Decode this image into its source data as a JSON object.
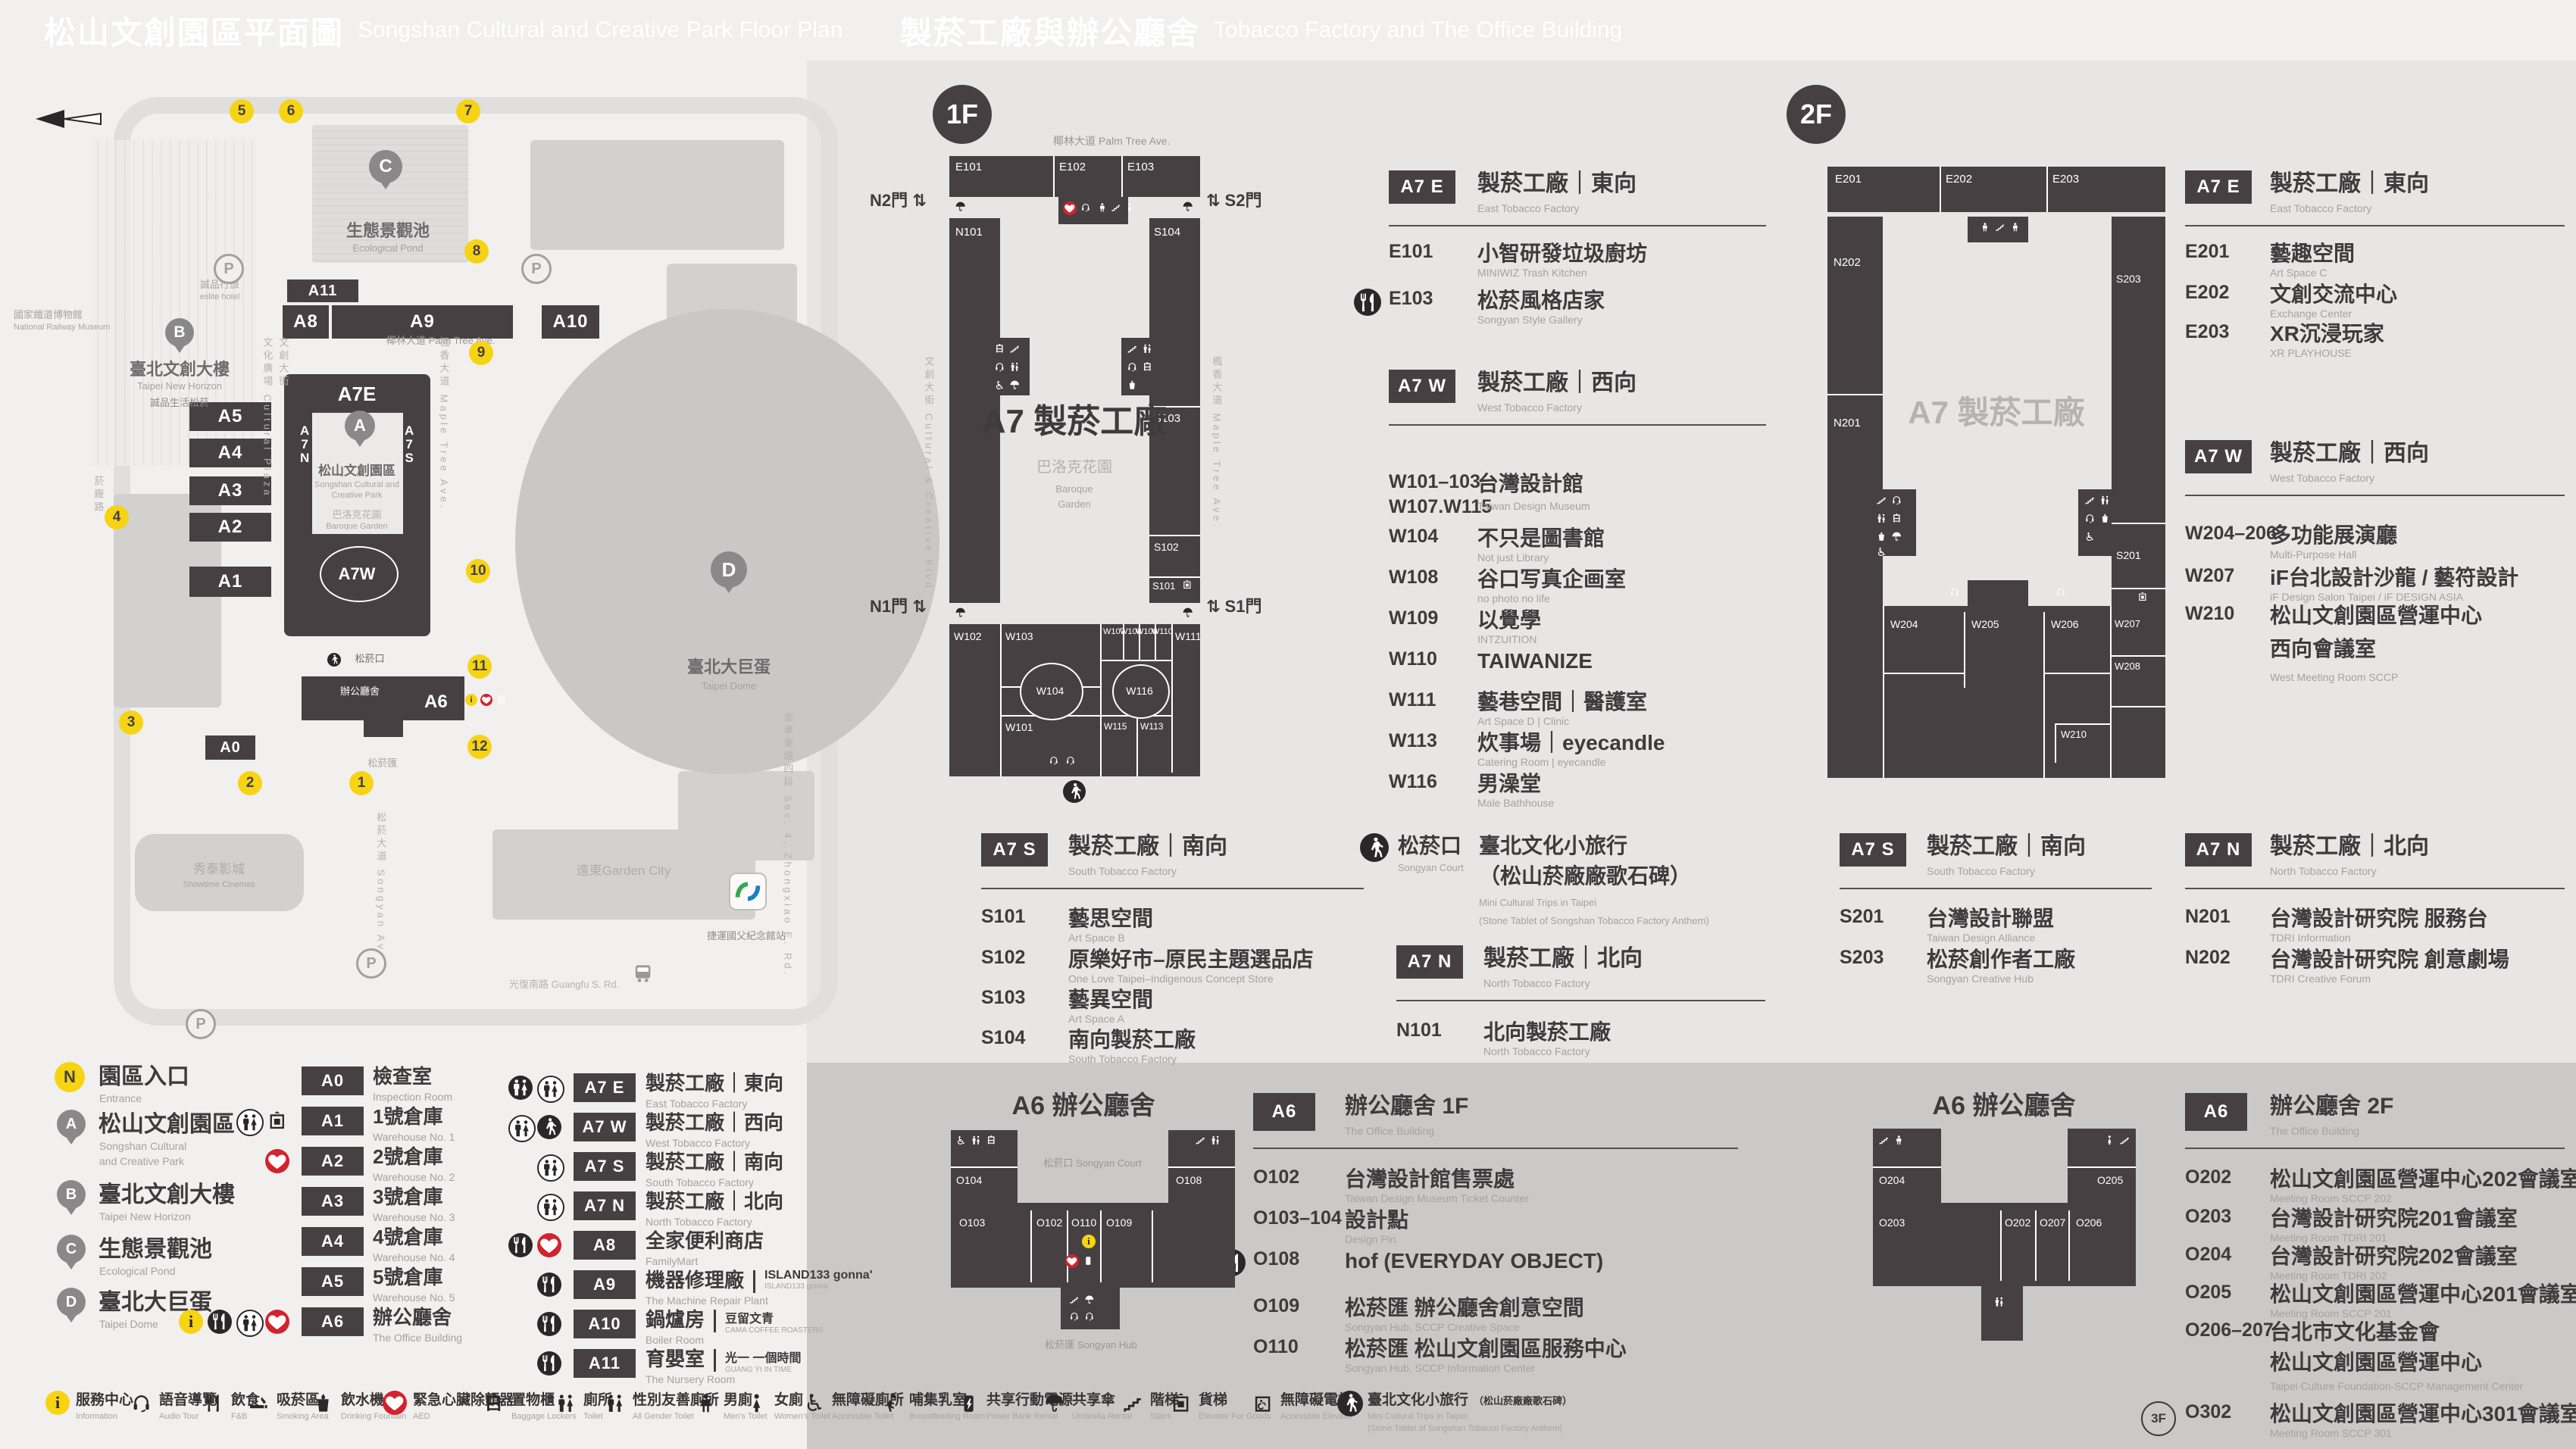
{
  "header_left": {
    "zh": "松山文創園區平面圖",
    "en": "Songshan Cultural and Creative Park Floor Plan"
  },
  "header_right": {
    "zh": "製菸工廠與辦公廳舍",
    "en": "Tobacco Factory and The Office Building"
  },
  "map": {
    "streets": [
      {
        "zh": "椰林大道",
        "en": "Palm Tree Ave."
      },
      {
        "zh": "文創大街",
        "en": "Cultural & Creative Blvd."
      },
      {
        "zh": "文化廣場",
        "en": "Cultural Plaza"
      },
      {
        "zh": "楓香大道",
        "en": "Maple Tree Ave."
      },
      {
        "zh": "菸廠路",
        "en": ""
      },
      {
        "zh": "松菸大道",
        "en": "Songyan Ave."
      },
      {
        "zh": "光復南路",
        "en": "Guangfu S. Rd."
      },
      {
        "zh": "忠孝東路四段",
        "en": "Sec. 4, Zhongxiao E. Rd."
      }
    ],
    "places": [
      {
        "zh": "國家鐵道博物館",
        "en": "National Railway Museum"
      },
      {
        "zh": "誠品行旅",
        "en": "eslite hotel"
      },
      {
        "zh": "誠品生活松菸",
        "en": ""
      },
      {
        "zh": "秀泰影城",
        "en": "Showtime Cinemas"
      },
      {
        "zh": "遠東Garden City",
        "en": ""
      },
      {
        "zh": "捷運國父紀念館站",
        "en": ""
      },
      {
        "zh": "松菸口",
        "en": "Songyan Court"
      },
      {
        "zh": "辦公廳舍",
        "en": "The Office Building"
      },
      {
        "zh": "松菸匯",
        "en": "Songyan Hub"
      },
      {
        "zh": "巴洛克花園",
        "en": "Baroque Garden"
      },
      {
        "zh": "生態景觀池",
        "en": "Ecological Pond"
      },
      {
        "zh": "臺北大巨蛋",
        "en": "Taipei Dome"
      },
      {
        "zh": "松山文創園區",
        "en1": "Songshan Cultural and",
        "en2": "Creative Park"
      },
      {
        "zh": "臺北文創大樓",
        "en": "Taipei New Horizon"
      }
    ],
    "bars": [
      "A11",
      "A8",
      "A9",
      "A10",
      "A5",
      "A4",
      "A3",
      "A2",
      "A1",
      "A0",
      "A6",
      "A7E",
      "A7W",
      "A7N",
      "A7S"
    ],
    "entrances": [
      "1",
      "2",
      "3",
      "4",
      "5",
      "6",
      "7",
      "8",
      "9",
      "10",
      "11",
      "12"
    ]
  },
  "legend": {
    "places": [
      {
        "marker": "N",
        "zh": "園區入口",
        "en1": "Entrance",
        "en2": ""
      },
      {
        "marker": "A",
        "zh": "松山文創園區",
        "en1": "Songshan Cultural",
        "en2": "and Creative Park"
      },
      {
        "marker": "B",
        "zh": "臺北文創大樓",
        "en1": "Taipei New Horizon",
        "en2": ""
      },
      {
        "marker": "C",
        "zh": "生態景觀池",
        "en1": "Ecological Pond",
        "en2": ""
      },
      {
        "marker": "D",
        "zh": "臺北大巨蛋",
        "en1": "Taipei Dome",
        "en2": ""
      }
    ],
    "buildings": [
      {
        "code": "A0",
        "zh": "檢查室",
        "en": "Inspection Room",
        "icons": []
      },
      {
        "code": "A1",
        "zh": "1號倉庫",
        "en": "Warehouse No. 1",
        "icons": [
          "goodsel_p",
          "toilet_o"
        ]
      },
      {
        "code": "A2",
        "zh": "2號倉庫",
        "en": "Warehouse No. 2",
        "icons": [
          "aed"
        ]
      },
      {
        "code": "A3",
        "zh": "3號倉庫",
        "en": "Warehouse No. 3",
        "icons": []
      },
      {
        "code": "A4",
        "zh": "4號倉庫",
        "en": "Warehouse No. 4",
        "icons": []
      },
      {
        "code": "A5",
        "zh": "5號倉庫",
        "en": "Warehouse No. 5",
        "icons": []
      },
      {
        "code": "A6",
        "zh": "辦公廳舍",
        "en": "The Office Building",
        "icons": [
          "aed",
          "toilet_o",
          "fnb_s",
          "info"
        ]
      },
      {
        "code": "A7 E",
        "zh": "製菸工廠｜東向",
        "en": "East Tobacco Factory",
        "icons": [
          "toilet_o",
          "toilet_s"
        ]
      },
      {
        "code": "A7 W",
        "zh": "製菸工廠｜西向",
        "en": "West Tobacco Factory",
        "icons": [
          "walk_s",
          "toilet_o"
        ]
      },
      {
        "code": "A7 S",
        "zh": "製菸工廠｜南向",
        "en": "South Tobacco Factory",
        "icons": [
          "toilet_o"
        ]
      },
      {
        "code": "A7 N",
        "zh": "製菸工廠｜北向",
        "en": "North Tobacco Factory",
        "icons": [
          "toilet_o"
        ]
      },
      {
        "code": "A8",
        "zh": "全家便利商店",
        "en": "FamilyMart",
        "icons": [
          "aed",
          "fnb_s"
        ]
      },
      {
        "code": "A9",
        "zh": "機器修理廠",
        "en": "The Machine Repair Plant",
        "brand": "ISLAND133 gonna'",
        "brand_sub": "ISLAND133 gonna'",
        "icons": [
          "fnb_s"
        ]
      },
      {
        "code": "A10",
        "zh": "鍋爐房",
        "en": "Boiler Room",
        "brand": "豆留文青",
        "brand_sub": "CAMA COFFEE ROASTERS",
        "icons": [
          "fnb_s"
        ]
      },
      {
        "code": "A11",
        "zh": "育嬰室",
        "en": "The Nursery Room",
        "brand": "光一 一個時間",
        "brand_sub": "GUANG YI IN TIME",
        "icons": [
          "fnb_s"
        ]
      }
    ]
  },
  "facilities": [
    {
      "icon": "info",
      "zh": "服務中心",
      "en": "Information"
    },
    {
      "icon": "audio",
      "zh": "語音導覽",
      "en": "Audio Tour"
    },
    {
      "icon": "fnb",
      "zh": "飲食",
      "en": "F&B"
    },
    {
      "icon": "smoking",
      "zh": "吸菸區",
      "en": "Smoking Area"
    },
    {
      "icon": "water",
      "zh": "飲水機",
      "en": "Drinking Fountain"
    },
    {
      "icon": "aed",
      "zh": "緊急心臟除顫器",
      "en": "AED"
    },
    {
      "icon": "locker",
      "zh": "置物櫃",
      "en": "Baggage Lockers"
    },
    {
      "icon": "toilet",
      "zh": "廁所",
      "en": "Toilet"
    },
    {
      "icon": "allgender",
      "zh": "性別友善廁所",
      "en": "All Gender Toilet"
    },
    {
      "icon": "mens",
      "zh": "男廁",
      "en": "Men's Toilet"
    },
    {
      "icon": "womens",
      "zh": "女廁",
      "en": "Women's Toilet"
    },
    {
      "icon": "accessible",
      "zh": "無障礙廁所",
      "en": "Accessible Toilet"
    },
    {
      "icon": "nursing",
      "zh": "哺集乳室",
      "en": "Breastfeeding Room"
    },
    {
      "icon": "powerbank",
      "zh": "共享行動電源",
      "en": "Power Bank Rental"
    },
    {
      "icon": "umbrella",
      "zh": "共享傘",
      "en": "Umbrella Rental"
    },
    {
      "icon": "stairs",
      "zh": "階梯",
      "en": "Stairs"
    },
    {
      "icon": "goodsel",
      "zh": "貨梯",
      "en": "Elevator For Goods"
    },
    {
      "icon": "accel",
      "zh": "無障礙電梯",
      "en": "Accessible Elevator"
    },
    {
      "icon": "minitrip",
      "zh": "臺北文化小旅行",
      "zh2": "（松山菸廠廠歌石碑）",
      "en": "Mini Cultural Trips in Taipei",
      "en2": "(Stone Tablet of Songshan Tobacco Factory Anthem)"
    }
  ],
  "floor1": {
    "badge": "1F",
    "plan": {
      "rooms": [
        "E101",
        "E102",
        "E103",
        "N101",
        "S104",
        "S103",
        "S102",
        "S101",
        "W102",
        "W103",
        "W104",
        "W101",
        "W107",
        "W108",
        "W109",
        "W110",
        "W116",
        "W115",
        "W113",
        "W111"
      ],
      "gates": [
        "N2門 ⇅",
        "⇅ S2門",
        "N1門 ⇅",
        "⇅ S1門"
      ],
      "center": "A7 製菸工廠",
      "garden_zh": "巴洛克花園",
      "garden_en1": "Baroque",
      "garden_en2": "Garden",
      "street_top_zh": "椰林大道",
      "street_top_en": "Palm Tree Ave.",
      "street_left": "文創大街 Cultural & Creative Blvd.",
      "street_right": "楓香大道 Maple Tree Ave."
    },
    "sections": [
      {
        "badge": "A7 E",
        "zh": "製菸工廠｜東向",
        "en": "East Tobacco Factory",
        "rooms": [
          {
            "code": "E101",
            "zh": "小智研發垃圾廚坊",
            "en": "MINIWIZ Trash Kitchen"
          },
          {
            "code": "E103",
            "zh": "松菸風格店家",
            "en": "Songyan Style Gallery",
            "icon": "fnb_s"
          }
        ]
      },
      {
        "badge": "A7 W",
        "zh": "製菸工廠｜西向",
        "en": "West Tobacco Factory",
        "rooms": [
          {
            "code": "W101–103",
            "code2": "W107.W115",
            "zh": "台灣設計館",
            "en": "Taiwan Design Museum"
          },
          {
            "code": "W104",
            "zh": "不只是圖書館",
            "en": "Not just Library"
          },
          {
            "code": "W108",
            "zh": "谷口写真企画室",
            "en": "no photo no life"
          },
          {
            "code": "W109",
            "zh": "以覺學",
            "en": "INTZUITION"
          },
          {
            "code": "W110",
            "zh": "TAIWANIZE",
            "en": ""
          },
          {
            "code": "W111",
            "zh": "藝巷空間｜醫護室",
            "en": "Art Space D | Clinic"
          },
          {
            "code": "W113",
            "zh": "炊事場｜eyecandle",
            "en": "Catering Room | eyecandle"
          },
          {
            "code": "W116",
            "zh": "男澡堂",
            "en": "Male Bathhouse"
          }
        ]
      },
      {
        "badge": "A7 S",
        "zh": "製菸工廠｜南向",
        "en": "South Tobacco Factory",
        "rooms": [
          {
            "code": "S101",
            "zh": "藝思空間",
            "en": "Art Space B"
          },
          {
            "code": "S102",
            "zh": "原樂好市–原民主題選品店",
            "en": "One Love Taipei–Indigenous Concept Store"
          },
          {
            "code": "S103",
            "zh": "藝異空間",
            "en": "Art Space A"
          },
          {
            "code": "S104",
            "zh": "南向製菸工廠",
            "en": "South Tobacco Factory"
          }
        ]
      },
      {
        "badge": "A7 N",
        "zh": "製菸工廠｜北向",
        "en": "North Tobacco Factory",
        "rooms": [
          {
            "code": "N101",
            "zh": "北向製菸工廠",
            "en": "North Tobacco Factory"
          }
        ]
      }
    ],
    "court": {
      "zh": "松菸口",
      "en": "Songyan Court",
      "name_zh": "臺北文化小旅行",
      "name_zh2": "（松山菸廠廠歌石碑）",
      "name_en": "Mini Cultural Trips in Taipei",
      "name_en2": "(Stone Tablet of Songshan Tobacco Factory Anthem)"
    },
    "office": {
      "badge": "A6",
      "zh": "辦公廳舍 1F",
      "en": "The Office Building",
      "plan_title": "A6 辦公廳舍",
      "plan_court": "松菸口 Songyan Court",
      "plan_hub": "松菸匯 Songyan Hub",
      "plan_rooms": [
        "O104",
        "O108",
        "O103",
        "O102",
        "O110",
        "O109"
      ],
      "rooms": [
        {
          "code": "O102",
          "zh": "台灣設計館售票處",
          "en": "Taiwan Design Museum Ticket Counter"
        },
        {
          "code": "O103–104",
          "zh": "設計點",
          "en": "Design Pin"
        },
        {
          "code": "O108",
          "zh": "hof (EVERYDAY OBJECT)",
          "en": "",
          "icon": "fnb_s"
        },
        {
          "code": "O109",
          "zh": "松菸匯 辦公廳舍創意空間",
          "en": "Songyan Hub, SCCP Creative Space"
        },
        {
          "code": "O110",
          "zh": "松菸匯 松山文創園區服務中心",
          "en": "Songyan Hub, SCCP Information Center"
        }
      ]
    }
  },
  "floor2": {
    "badge": "2F",
    "plan": {
      "rooms": [
        "E201",
        "E202",
        "E203",
        "N202",
        "N201",
        "S203",
        "S201",
        "W204",
        "W205",
        "W206",
        "W207",
        "W208",
        "W210"
      ],
      "center": "A7 製菸工廠"
    },
    "sections": [
      {
        "badge": "A7 E",
        "zh": "製菸工廠｜東向",
        "en": "East Tobacco Factory",
        "rooms": [
          {
            "code": "E201",
            "zh": "藝趣空間",
            "en": "Art Space C"
          },
          {
            "code": "E202",
            "zh": "文創交流中心",
            "en": "Exchange Center"
          },
          {
            "code": "E203",
            "zh": "XR沉浸玩家",
            "en": "XR PLAYHOUSE"
          }
        ]
      },
      {
        "badge": "A7 W",
        "zh": "製菸工廠｜西向",
        "en": "West Tobacco Factory",
        "rooms": [
          {
            "code": "W204–206",
            "zh": "多功能展演廳",
            "en": "Multi-Purpose Hall"
          },
          {
            "code": "W207",
            "zh": "iF台北設計沙龍 / 藝符設計",
            "en": "iF Design Salon Taipei / iF DESIGN ASIA"
          },
          {
            "code": "W210",
            "zh": "松山文創園區營運中心",
            "zh2": "西向會議室",
            "en": "West Meeting Room SCCP"
          }
        ]
      },
      {
        "badge": "A7 S",
        "zh": "製菸工廠｜南向",
        "en": "South Tobacco Factory",
        "rooms": [
          {
            "code": "S201",
            "zh": "台灣設計聯盟",
            "en": "Taiwan Design Alliance"
          },
          {
            "code": "S203",
            "zh": "松菸創作者工廠",
            "en": "Songyan Creative Hub"
          }
        ]
      },
      {
        "badge": "A7 N",
        "zh": "製菸工廠｜北向",
        "en": "North Tobacco Factory",
        "rooms": [
          {
            "code": "N201",
            "zh": "台灣設計研究院 服務台",
            "en": "TDRI Information"
          },
          {
            "code": "N202",
            "zh": "台灣設計研究院 創意劇場",
            "en": "TDRI Creative Forum"
          }
        ]
      }
    ],
    "office": {
      "badge": "A6",
      "zh": "辦公廳舍 2F",
      "en": "The Office Building",
      "plan_title": "A6 辦公廳舍",
      "plan_rooms": [
        "O204",
        "O205",
        "O203",
        "O202",
        "O207",
        "O206"
      ],
      "rooms": [
        {
          "code": "O202",
          "zh": "松山文創園區營運中心202會議室",
          "en": "Meeting Room SCCP 202"
        },
        {
          "code": "O203",
          "zh": "台灣設計研究院201會議室",
          "en": "Meeting Room TDRI 201"
        },
        {
          "code": "O204",
          "zh": "台灣設計研究院202會議室",
          "en": "Meeting Room TDRI 202"
        },
        {
          "code": "O205",
          "zh": "松山文創園區營運中心201會議室",
          "en": "Meeting Room SCCP 201"
        },
        {
          "code": "O206–207",
          "zh": "台北市文化基金會",
          "zh2": "松山文創園區營運中心",
          "en": "Taipei Culture Foundation-SCCP Management Center"
        },
        {
          "code": "O302",
          "prefix": "3F",
          "zh": "松山文創園區營運中心301會議室",
          "en": "Meeting Room SCCP 301"
        }
      ]
    }
  }
}
